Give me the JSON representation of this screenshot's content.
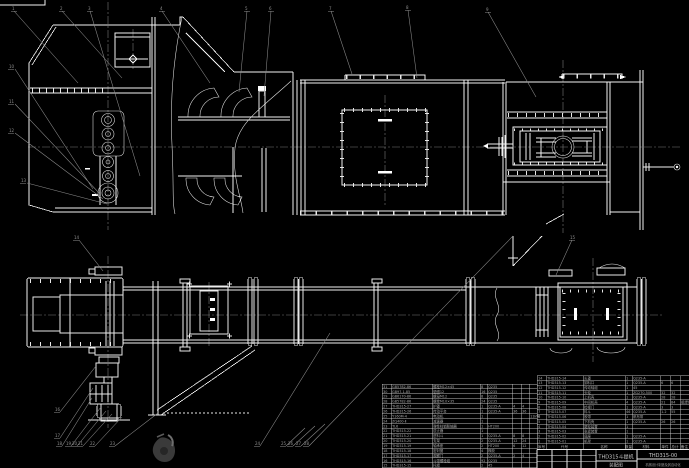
{
  "drawing": {
    "title": "THD315斗提机",
    "subtitle": "装配图",
    "drawing_no": "THD315-00",
    "org": "机械设计制造及其自动化",
    "colors": {
      "background": "#000000",
      "line": "#f2f2f2",
      "leader": "#8c8c8c",
      "centerline": "#7a7a7a",
      "table_text": "#a8a8a8",
      "title_text": "#c8c8c8",
      "watermark": "#3a3a3a"
    }
  },
  "bom_right": {
    "headers": [
      "序号",
      "代号",
      "名称",
      "数量",
      "材料",
      "单件",
      "总计",
      "备注"
    ],
    "rows": [
      [
        "14",
        "THD315-14",
        "头罩",
        "1",
        "Q235-A",
        "",
        "",
        ""
      ],
      [
        "13",
        "THD315-13",
        "卸料口",
        "1",
        "Q235-A",
        "6",
        "6",
        ""
      ],
      [
        "12",
        "THD315-12",
        "传动轴组",
        "1",
        "45",
        "",
        "",
        ""
      ],
      [
        "11",
        "THD315-11",
        "头轮",
        "1",
        "ZG270-500",
        "32",
        "32",
        ""
      ],
      [
        "10",
        "THD315-10",
        "上机壳",
        "1",
        "Q235-A",
        "28",
        "28",
        ""
      ],
      [
        "9",
        "THD315-09",
        "中间机壳",
        "4",
        "Q235-A",
        "21",
        "84",
        "组焊件"
      ],
      [
        "8",
        "THD315-08",
        "检视门",
        "1",
        "Q235-A",
        "3",
        "3",
        ""
      ],
      [
        "7",
        "THD315-07",
        "料斗",
        "46",
        "Q235-A",
        "1.2",
        "55",
        ""
      ],
      [
        "6",
        "THD315-06",
        "胶带",
        "1",
        "帆布带",
        "",
        "",
        ""
      ],
      [
        "5",
        "THD315-05",
        "下机壳",
        "1",
        "Q235-A",
        "26",
        "26",
        ""
      ],
      [
        "4",
        "THD315-04",
        "尾轮装置",
        "1",
        "",
        "",
        "",
        ""
      ],
      [
        "3",
        "THD315-03",
        "张紧装置",
        "1",
        "",
        "",
        "",
        ""
      ],
      [
        "2",
        "THD315-02",
        "底座",
        "1",
        "Q235-A",
        "",
        "",
        ""
      ],
      [
        "1",
        "THD315-01",
        "机架",
        "1",
        "Q235-A",
        "",
        "",
        ""
      ]
    ]
  },
  "bom_left": {
    "rows": [
      [
        "31",
        "GB5782-86",
        "螺栓M12×45",
        "8",
        "Q235",
        "",
        "",
        ""
      ],
      [
        "30",
        "GB97.1-85",
        "垫圈12",
        "16",
        "Q235",
        "",
        "",
        ""
      ],
      [
        "29",
        "GB6170-86",
        "螺母M12",
        "8",
        "Q235",
        "",
        "",
        ""
      ],
      [
        "28",
        "GB5782-86",
        "螺栓M10×35",
        "24",
        "Q235",
        "",
        "",
        ""
      ],
      [
        "27",
        "THD315-27",
        "护罩",
        "1",
        "Q235-A",
        "4",
        "4",
        ""
      ],
      [
        "26",
        "THD315-26",
        "传动平台",
        "1",
        "Q235-A",
        "36",
        "36",
        ""
      ],
      [
        "25",
        "Y160M-4",
        "电动机",
        "1",
        "",
        "",
        "",
        "11kW"
      ],
      [
        "24",
        "ZQ400-Ⅱ",
        "减速器",
        "1",
        "",
        "",
        "",
        ""
      ],
      [
        "23",
        "TL6",
        "弹性柱销联轴器",
        "1",
        "HT200",
        "",
        "",
        ""
      ],
      [
        "22",
        "THD315-22",
        "逆止器",
        "1",
        "",
        "",
        "",
        ""
      ],
      [
        "21",
        "THD315-21",
        "进料斗",
        "1",
        "Q235-A",
        "8",
        "8",
        ""
      ],
      [
        "20",
        "THD315-20",
        "支架",
        "2",
        "Q235-A",
        "12",
        "24",
        ""
      ],
      [
        "19",
        "THD315-19",
        "轴承座",
        "2",
        "HT200",
        "6",
        "12",
        ""
      ],
      [
        "18",
        "THD315-18",
        "密封圈",
        "4",
        "橡胶",
        "",
        "",
        ""
      ],
      [
        "17",
        "THD315-17",
        "观察门",
        "2",
        "Q235-A",
        "2",
        "4",
        ""
      ],
      [
        "16",
        "THD315-16",
        "斗带螺栓组",
        "92",
        "Q235",
        "",
        "",
        ""
      ],
      [
        "15",
        "THD315-15",
        "托辊",
        "2",
        "45",
        "",
        "",
        ""
      ]
    ]
  },
  "callouts": [
    {
      "label": "1",
      "x": 12,
      "y": 6
    },
    {
      "label": "2",
      "x": 60,
      "y": 6
    },
    {
      "label": "3",
      "x": 88,
      "y": 6
    },
    {
      "label": "4",
      "x": 160,
      "y": 6
    },
    {
      "label": "5",
      "x": 245,
      "y": 6
    },
    {
      "label": "6",
      "x": 269,
      "y": 6
    },
    {
      "label": "7",
      "x": 329,
      "y": 6
    },
    {
      "label": "8",
      "x": 406,
      "y": 5
    },
    {
      "label": "9",
      "x": 486,
      "y": 7
    },
    {
      "label": "10",
      "x": 9,
      "y": 64
    },
    {
      "label": "11",
      "x": 9,
      "y": 99
    },
    {
      "label": "12",
      "x": 9,
      "y": 128
    },
    {
      "label": "13",
      "x": 21,
      "y": 178
    },
    {
      "label": "14",
      "x": 74,
      "y": 235
    },
    {
      "label": "15",
      "x": 570,
      "y": 235
    },
    {
      "label": "16",
      "x": 55,
      "y": 407
    },
    {
      "label": "17",
      "x": 55,
      "y": 433
    },
    {
      "label": "18",
      "x": 57,
      "y": 441
    },
    {
      "label": "19",
      "x": 66,
      "y": 441
    },
    {
      "label": "20",
      "x": 72,
      "y": 441
    },
    {
      "label": "21",
      "x": 78,
      "y": 441
    },
    {
      "label": "22",
      "x": 90,
      "y": 441
    },
    {
      "label": "23",
      "x": 110,
      "y": 441
    },
    {
      "label": "24",
      "x": 255,
      "y": 441
    },
    {
      "label": "25",
      "x": 281,
      "y": 441
    },
    {
      "label": "26",
      "x": 288,
      "y": 441
    },
    {
      "label": "27",
      "x": 296,
      "y": 441
    },
    {
      "label": "28",
      "x": 304,
      "y": 441
    }
  ]
}
